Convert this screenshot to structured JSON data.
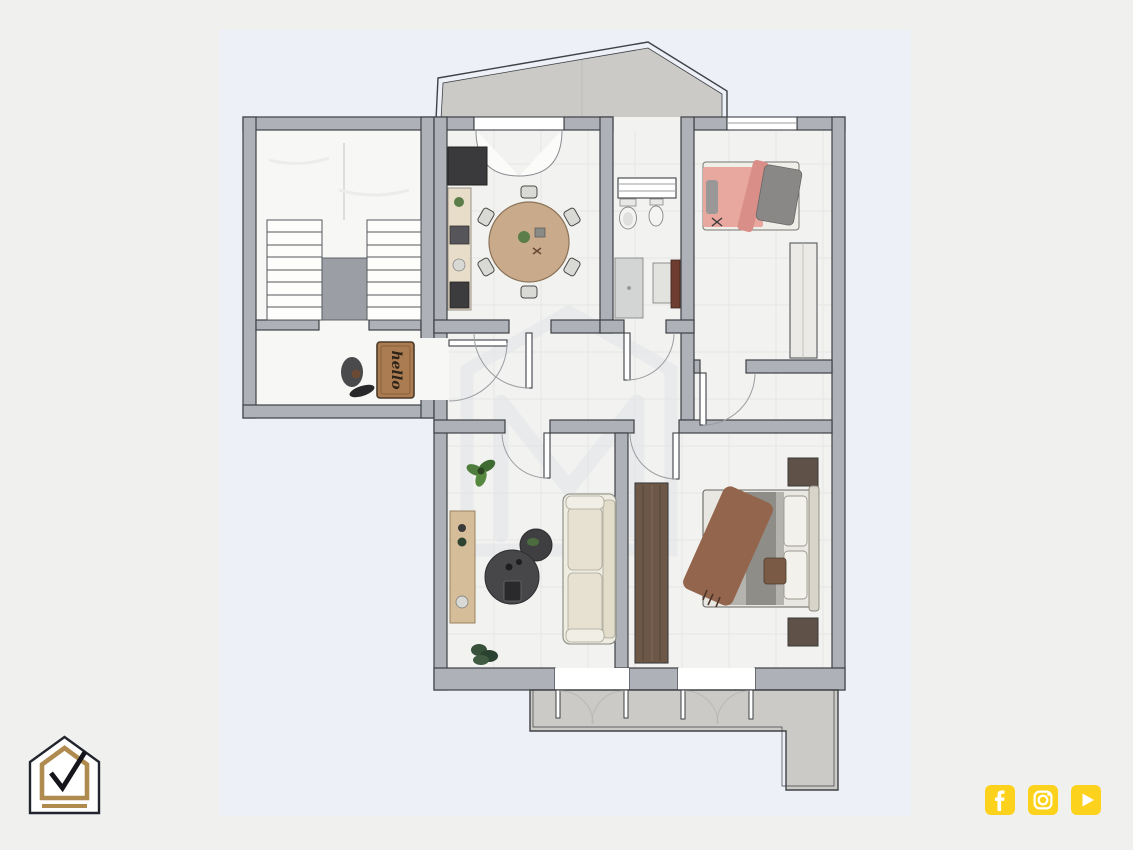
{
  "page_type": "real-estate-floor-plan-render",
  "plan": {
    "entry_mat_text": "hello",
    "watermark_letter": "M",
    "rooms": [
      "stairwell",
      "entrance-landing",
      "kitchen-dining",
      "bathroom",
      "bedroom-small",
      "hallway",
      "living-room",
      "bedroom-master",
      "terrace-top",
      "balcony-bottom"
    ],
    "furniture": [
      "u-shaped-staircase",
      "hello-doormat",
      "entry-statue",
      "fridge",
      "kitchen-counter",
      "round-dining-table-6-chairs",
      "toilet",
      "bidet",
      "shower",
      "vanity-sink",
      "single-bed-pink",
      "wardrobe",
      "sofa-cream",
      "coffee-tables-round",
      "sideboard",
      "plants",
      "double-bed-brown-throw",
      "nightstands",
      "wardrobe-dark-wood"
    ]
  },
  "branding": {
    "logo_name": "house-checkmark-logo"
  },
  "social": {
    "icons": [
      {
        "name": "facebook-icon",
        "glyph": "f"
      },
      {
        "name": "instagram-icon",
        "glyph": "camera"
      },
      {
        "name": "youtube-icon",
        "glyph": "play"
      }
    ]
  },
  "colors": {
    "page_bg": "#f0f0ee",
    "plan_bg": "#edf0f6",
    "wall": "#aeb1b7",
    "wall_outline": "#3e4146",
    "floor": "#f2f2f0",
    "marble": "#f7f7f6",
    "terrace": "#cbcac6",
    "mat_brown": "#ab7c52",
    "wood_dark": "#6d5848",
    "wood_light": "#d6bd99",
    "dining_table": "#c9ab8c",
    "sofa_cream": "#e9e5d6",
    "blanket_pink": "#e8a8a0",
    "throw_brown": "#93654d",
    "social_yellow": "#fcd21c",
    "logo_gold": "#b08b4f",
    "logo_dark": "#23252e"
  }
}
